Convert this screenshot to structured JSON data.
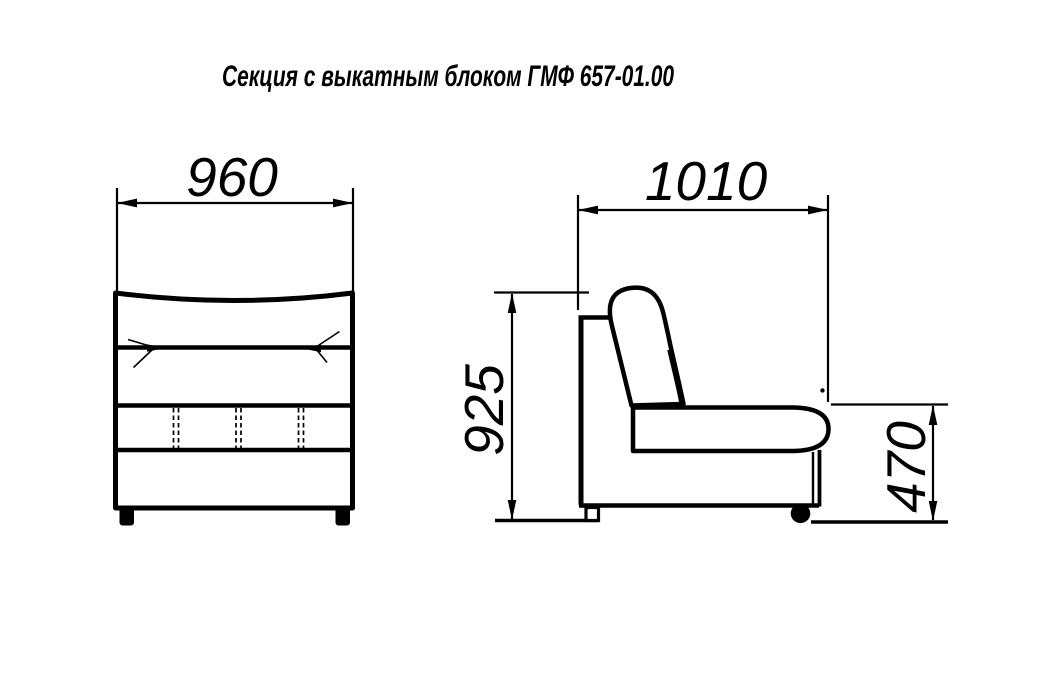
{
  "title": "Секция с выкатным блоком ГМФ 657-01.00",
  "colors": {
    "ink": "#000000",
    "paper": "#ffffff"
  },
  "views": {
    "front": {
      "dimensions": {
        "overall_width": "960"
      }
    },
    "side": {
      "dimensions": {
        "overall_depth": "1010",
        "overall_height": "925",
        "seat_height": "470"
      }
    }
  }
}
